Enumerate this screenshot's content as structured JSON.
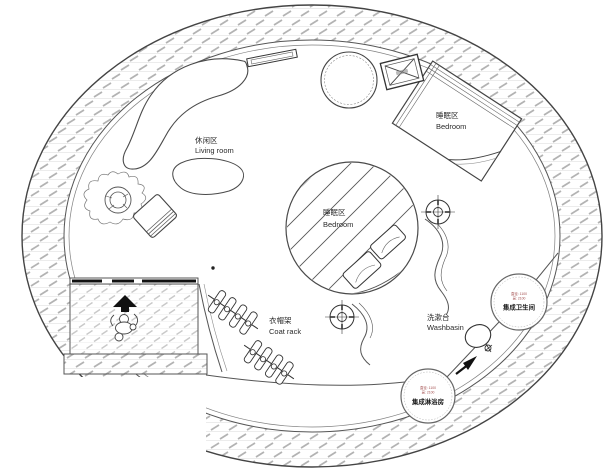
{
  "drawing": {
    "type": "floor-plan",
    "shape": "circular plan with rectangular entry bay at lower left"
  },
  "colors": {
    "line": "#444444",
    "wall_hatch_tick": "#b3b3b3",
    "floor_hatch_tick": "#c9c9c9",
    "spec_text": "#a14b4b",
    "solid_black": "#111111"
  },
  "rooms": {
    "living": {
      "zh": "休闲区",
      "en": "Living room"
    },
    "bedroom_top": {
      "zh": "睡眠区",
      "en": "Bedroom"
    },
    "bedroom_center": {
      "zh": "睡眠区",
      "en": "Bedroom"
    },
    "coat_rack": {
      "zh": "衣帽架",
      "en": "Coat rack"
    },
    "washbasin": {
      "zh": "洗漱台",
      "en": "Washbasin"
    }
  },
  "pods": {
    "bathroom": {
      "name": "集成卫生间",
      "spec1": "直径: 1100",
      "spec2": "高: 2100"
    },
    "shower": {
      "name": "集成淋浴房",
      "spec1": "直径: 1100",
      "spec2": "高: 2100"
    }
  },
  "symbols": {
    "entry_arrow": "entry direction arrow",
    "corridor_arrow": "circulation arrow",
    "crosshair": "ceiling fixture target symbol",
    "crossed_box": "equipment box with X"
  }
}
